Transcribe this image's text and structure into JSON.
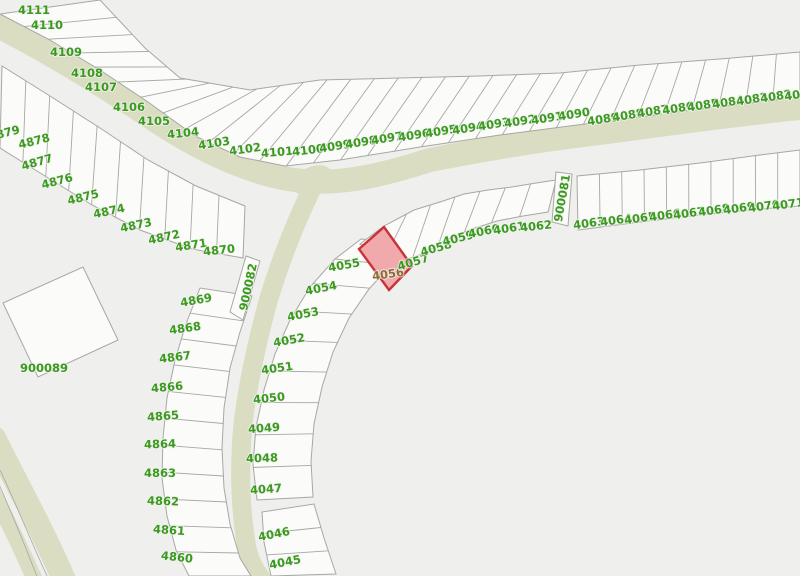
{
  "map": {
    "background": "#efefed",
    "road_color": "#daddc1",
    "parcel_fill": "#fbfbf9",
    "parcel_stroke": "#a7a7a4",
    "label_color": "#3a9a1e",
    "label_halo": "#f2f2f0",
    "highlight": {
      "parcel": "4056",
      "fill": "#f0aaac",
      "stroke": "#c93338",
      "label_color": "#8f6c35"
    },
    "parcel_labels": [
      {
        "t": "4111",
        "x": 34,
        "y": 10,
        "r": 0
      },
      {
        "t": "4110",
        "x": 47,
        "y": 25,
        "r": 0
      },
      {
        "t": "4109",
        "x": 66,
        "y": 52,
        "r": 0
      },
      {
        "t": "4108",
        "x": 87,
        "y": 73,
        "r": 0
      },
      {
        "t": "4107",
        "x": 101,
        "y": 87,
        "r": 0
      },
      {
        "t": "4106",
        "x": 129,
        "y": 107,
        "r": 0
      },
      {
        "t": "4105",
        "x": 154,
        "y": 121,
        "r": 0
      },
      {
        "t": "4104",
        "x": 183,
        "y": 133,
        "r": -6
      },
      {
        "t": "4103",
        "x": 214,
        "y": 143,
        "r": -9
      },
      {
        "t": "4102",
        "x": 245,
        "y": 149,
        "r": -8
      },
      {
        "t": "4101",
        "x": 277,
        "y": 152,
        "r": -5
      },
      {
        "t": "4100",
        "x": 308,
        "y": 150,
        "r": -7
      },
      {
        "t": "4099",
        "x": 335,
        "y": 146,
        "r": -9
      },
      {
        "t": "4098",
        "x": 361,
        "y": 142,
        "r": -9
      },
      {
        "t": "4097",
        "x": 387,
        "y": 138,
        "r": -9
      },
      {
        "t": "4096",
        "x": 414,
        "y": 135,
        "r": -9
      },
      {
        "t": "4095",
        "x": 441,
        "y": 131,
        "r": -9
      },
      {
        "t": "4094",
        "x": 468,
        "y": 128,
        "r": -9
      },
      {
        "t": "4093",
        "x": 494,
        "y": 124,
        "r": -9
      },
      {
        "t": "4092",
        "x": 520,
        "y": 121,
        "r": -9
      },
      {
        "t": "4091",
        "x": 547,
        "y": 118,
        "r": -9
      },
      {
        "t": "4090",
        "x": 574,
        "y": 114,
        "r": -9
      },
      {
        "t": "4089",
        "x": 603,
        "y": 119,
        "r": -9
      },
      {
        "t": "4088",
        "x": 628,
        "y": 115,
        "r": -9
      },
      {
        "t": "4087",
        "x": 653,
        "y": 111,
        "r": -9
      },
      {
        "t": "4086",
        "x": 678,
        "y": 108,
        "r": -9
      },
      {
        "t": "4085",
        "x": 703,
        "y": 105,
        "r": -9
      },
      {
        "t": "4084",
        "x": 728,
        "y": 102,
        "r": -9
      },
      {
        "t": "4083",
        "x": 752,
        "y": 99,
        "r": -9
      },
      {
        "t": "4082",
        "x": 776,
        "y": 96,
        "r": -9
      },
      {
        "t": "4081",
        "x": 800,
        "y": 94,
        "r": -9
      },
      {
        "t": "4879",
        "x": 4,
        "y": 133,
        "r": -14
      },
      {
        "t": "4878",
        "x": 34,
        "y": 141,
        "r": -14
      },
      {
        "t": "4877",
        "x": 37,
        "y": 162,
        "r": -16
      },
      {
        "t": "4876",
        "x": 57,
        "y": 181,
        "r": -15
      },
      {
        "t": "4875",
        "x": 83,
        "y": 197,
        "r": -14
      },
      {
        "t": "4874",
        "x": 109,
        "y": 211,
        "r": -12
      },
      {
        "t": "4873",
        "x": 136,
        "y": 225,
        "r": -12
      },
      {
        "t": "4872",
        "x": 164,
        "y": 237,
        "r": -12
      },
      {
        "t": "4871",
        "x": 191,
        "y": 245,
        "r": -9
      },
      {
        "t": "4870",
        "x": 219,
        "y": 250,
        "r": -6
      },
      {
        "t": "4869",
        "x": 196,
        "y": 300,
        "r": -10
      },
      {
        "t": "4868",
        "x": 185,
        "y": 328,
        "r": -8
      },
      {
        "t": "4867",
        "x": 175,
        "y": 357,
        "r": -7
      },
      {
        "t": "4866",
        "x": 167,
        "y": 387,
        "r": -5
      },
      {
        "t": "4865",
        "x": 163,
        "y": 416,
        "r": -4
      },
      {
        "t": "4864",
        "x": 160,
        "y": 444,
        "r": -2
      },
      {
        "t": "4863",
        "x": 160,
        "y": 473,
        "r": 0
      },
      {
        "t": "4862",
        "x": 163,
        "y": 501,
        "r": 2
      },
      {
        "t": "4861",
        "x": 169,
        "y": 530,
        "r": 4
      },
      {
        "t": "4860",
        "x": 177,
        "y": 557,
        "r": 6
      },
      {
        "t": "4055",
        "x": 344,
        "y": 265,
        "r": -10
      },
      {
        "t": "4054",
        "x": 321,
        "y": 288,
        "r": -11
      },
      {
        "t": "4053",
        "x": 303,
        "y": 314,
        "r": -11
      },
      {
        "t": "4052",
        "x": 289,
        "y": 340,
        "r": -10
      },
      {
        "t": "4051",
        "x": 277,
        "y": 368,
        "r": -8
      },
      {
        "t": "4050",
        "x": 269,
        "y": 398,
        "r": -6
      },
      {
        "t": "4049",
        "x": 264,
        "y": 428,
        "r": -4
      },
      {
        "t": "4048",
        "x": 262,
        "y": 458,
        "r": -2
      },
      {
        "t": "4047",
        "x": 266,
        "y": 489,
        "r": -4
      },
      {
        "t": "4046",
        "x": 274,
        "y": 534,
        "r": -11
      },
      {
        "t": "4045",
        "x": 285,
        "y": 562,
        "r": -11
      },
      {
        "t": "4056",
        "x": 388,
        "y": 274,
        "r": -8,
        "hl": true
      },
      {
        "t": "4057",
        "x": 413,
        "y": 262,
        "r": -17
      },
      {
        "t": "4058",
        "x": 436,
        "y": 248,
        "r": -16
      },
      {
        "t": "4059",
        "x": 458,
        "y": 238,
        "r": -14
      },
      {
        "t": "4060",
        "x": 484,
        "y": 231,
        "r": -11
      },
      {
        "t": "4061",
        "x": 509,
        "y": 228,
        "r": -9
      },
      {
        "t": "4062",
        "x": 536,
        "y": 226,
        "r": -6
      },
      {
        "t": "4063",
        "x": 589,
        "y": 223,
        "r": -8
      },
      {
        "t": "4064",
        "x": 616,
        "y": 220,
        "r": -8
      },
      {
        "t": "4065",
        "x": 640,
        "y": 218,
        "r": -8
      },
      {
        "t": "4066",
        "x": 665,
        "y": 215,
        "r": -8
      },
      {
        "t": "4067",
        "x": 689,
        "y": 213,
        "r": -8
      },
      {
        "t": "4068",
        "x": 714,
        "y": 210,
        "r": -8
      },
      {
        "t": "4069",
        "x": 739,
        "y": 208,
        "r": -8
      },
      {
        "t": "4070",
        "x": 764,
        "y": 206,
        "r": -8
      },
      {
        "t": "4071",
        "x": 788,
        "y": 204,
        "r": -8
      },
      {
        "t": "900081",
        "x": 562,
        "y": 198,
        "r": -80
      },
      {
        "t": "900082",
        "x": 248,
        "y": 287,
        "r": -78
      },
      {
        "t": "900089",
        "x": 44,
        "y": 368,
        "r": 0
      }
    ]
  }
}
